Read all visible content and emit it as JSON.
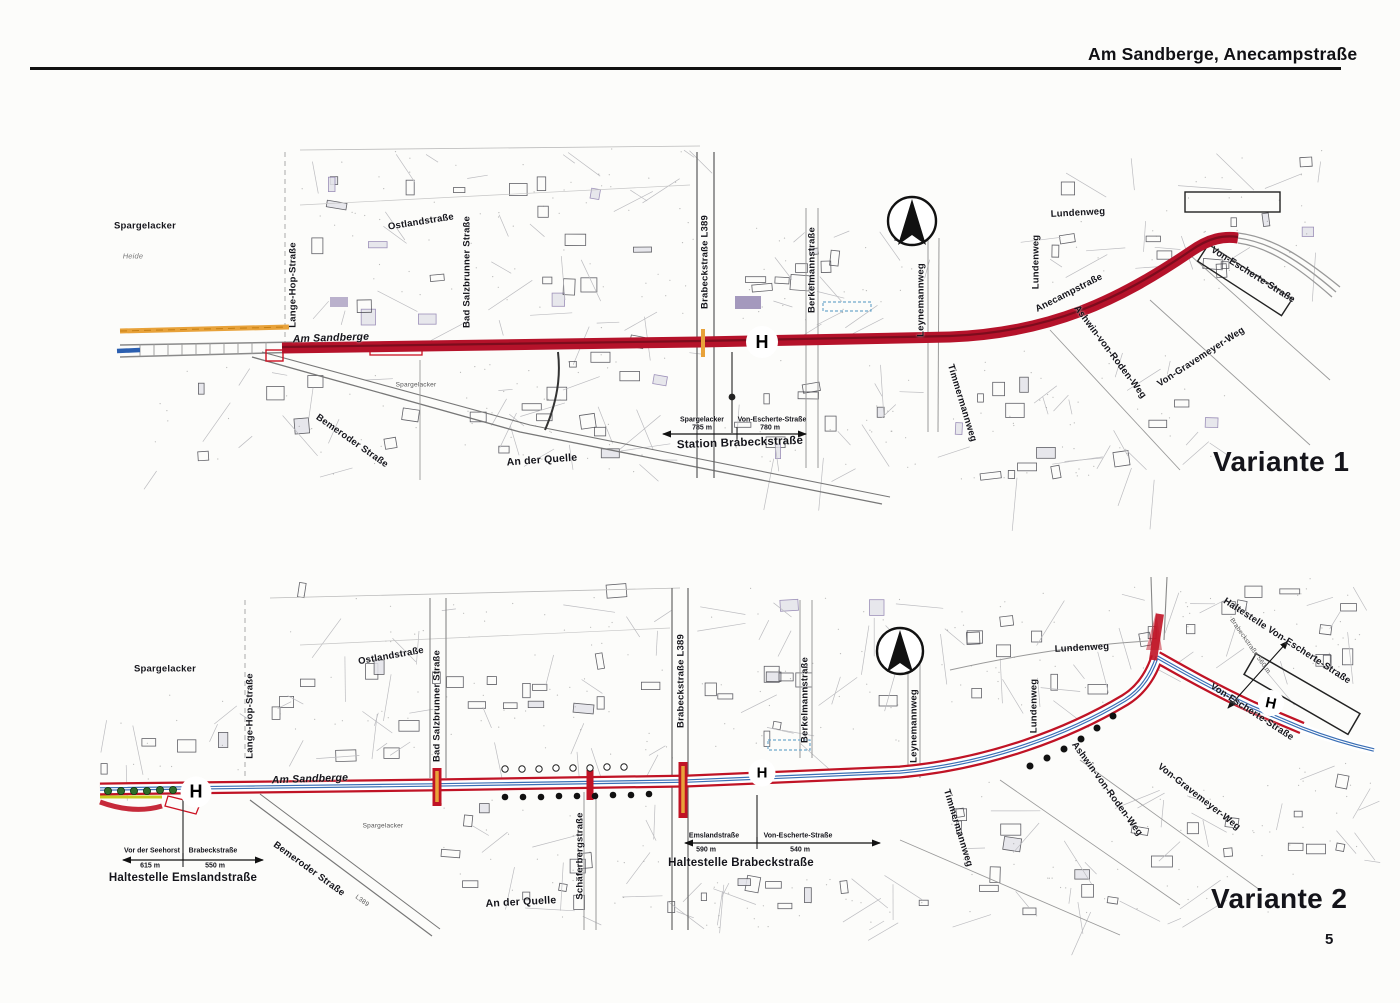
{
  "page": {
    "header_title": "Am Sandberge, Anecampstraße",
    "page_number": "5"
  },
  "stop_letter": "H",
  "colors": {
    "route_red": "#b5122a",
    "route_blue": "#3a6fb5",
    "crossing_orange": "#e8a23a",
    "tree_green": "#2e6f2a"
  },
  "map1": {
    "variant_label": "Variante 1",
    "street_labels": {
      "spargelacker": "Spargelacker",
      "heide": "Heide",
      "spargelacker_small": "Spargelacker",
      "lange_hop": "Lange-Hop-Straße",
      "ostlandstrasse": "Ostlandstraße",
      "bad_salzbrunner": "Bad Salzbrunner Straße",
      "am_sandberge": "Am Sandberge",
      "bemeroder": "Bemeroder Straße",
      "an_der_quelle": "An der Quelle",
      "brabeckstrasse": "Brabeckstraße   L389",
      "berkelmannstrasse": "Berkelmannstraße",
      "leynemannweg": "Leynemannweg",
      "timmermannweg": "Timmermannweg",
      "anecampstrasse": "Anecampstraße",
      "lundenweg_horizontal": "Lundenweg",
      "lundenweg_vertical": "Lundenweg",
      "von_escherte": "Von-Escherte-Straße",
      "ashwin_von_roden": "Ashwin-von-Roden-Weg",
      "von_gravemeyer": "Von-Gravemeyer-Weg"
    },
    "station_annotation": {
      "title": "Station Brabeckstraße",
      "left_name": "Spargelacker",
      "left_distance": "785 m",
      "right_name": "Von-Escherte-Straße",
      "right_distance": "780 m"
    }
  },
  "map2": {
    "variant_label": "Variante 2",
    "street_labels": {
      "spargelacker": "Spargelacker",
      "spargelacker_small": "Spargelacker",
      "ostlandstrasse": "Ostlandstraße",
      "lange_hop": "Lange-Hop-Straße",
      "bad_salzbrunner": "Bad Salzbrunner Straße",
      "am_sandberge": "Am Sandberge",
      "brabeckstrasse": "Brabeckstraße   L389",
      "berkelmannstrasse": "Berkelmannstraße",
      "leynemannweg": "Leynemannweg",
      "lundenweg_horizontal": "Lundenweg",
      "lundenweg_vertical": "Lundenweg",
      "schaeferbergstrasse": "Schäferbergstraße",
      "an_der_quelle": "An der Quelle",
      "bemeroder": "Bemeroder Straße",
      "bemeroder_ref": "L389",
      "timmermannweg": "Timmermannweg",
      "von_escherte": "Von-Escherte-Straße",
      "ashwin_von_roden": "Ashwin-von-Roden-Weg",
      "von_gravemeyer": "Von-Gravemeyer-Weg"
    },
    "stop_annotations": {
      "emsland": {
        "title": "Haltestelle Emslandstraße",
        "left_name": "Vor der Seehorst",
        "left_distance": "615 m",
        "right_name": "Brabeckstraße",
        "right_distance": "550 m"
      },
      "brabeck": {
        "title": "Haltestelle Brabeckstraße",
        "left_name": "Emslandstraße",
        "left_distance": "590 m",
        "right_name": "Von-Escherte-Straße",
        "right_distance": "540 m"
      },
      "von_escherte": {
        "title": "Haltestelle Von-Escherte-Straße",
        "pointer_name": "Brabeckstraße",
        "pointer_distance": "560 m"
      }
    }
  }
}
